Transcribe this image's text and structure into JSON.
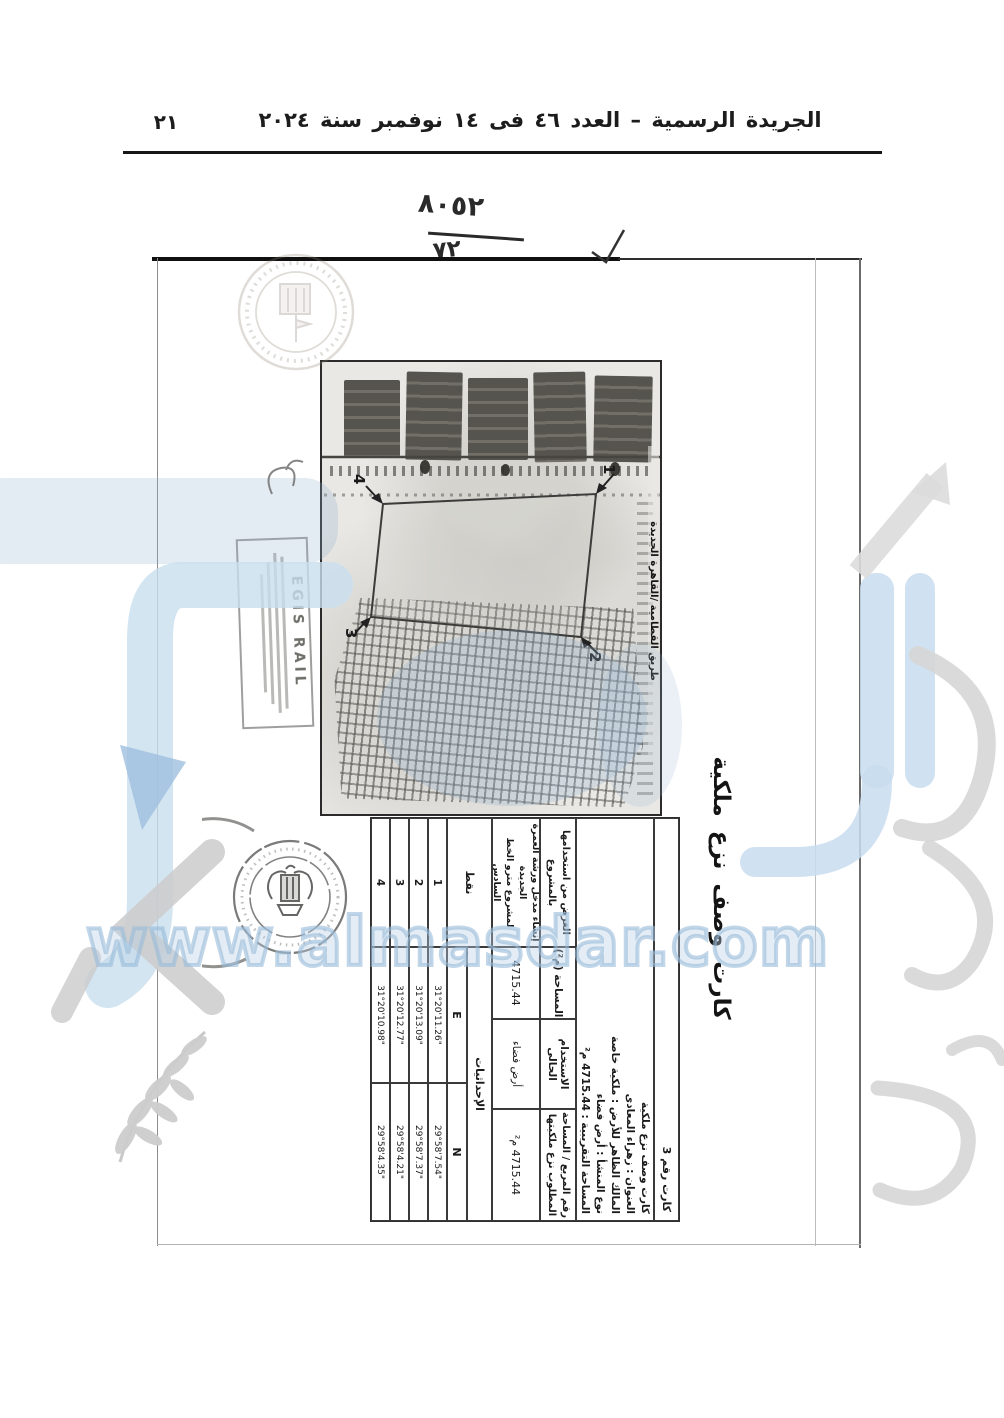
{
  "gazette": {
    "title": "الجريدة الرسمية – العدد ٤٦ فى ١٤ نوفمبر سنة ٢٠٢٤",
    "page_number": "٢١"
  },
  "annotations": {
    "fraction_top": "٨٠٥٢",
    "fraction_bottom": "٧٢"
  },
  "watermark": {
    "url": "www.almasdar.com",
    "blue": "#c8dcee",
    "tint": "#94b2d0",
    "gray": "#d6d6d6"
  },
  "card": {
    "title": "كارت وصف نزع ملكية",
    "card_no": "كارت رقم 3",
    "description": [
      "كارت وصف نزع ملكية",
      "العنوان : زهراء المعادى",
      "المالك الظاهر للأرض : ملكية خاصة",
      "نوع المنشأ : أرض فضاء",
      "المساحة التقريبية : 4715.44 م²"
    ],
    "map": {
      "road_label": "طريق القطامية /القاهرة الجديدة",
      "corners": [
        "1",
        "2",
        "3",
        "4"
      ]
    },
    "egis_stamp": "EGIS RAIL",
    "table": {
      "square_header_l1": "رقم المربع / المساحة",
      "square_header_l2": "المطلوب نزع ملكيتها",
      "square_value": "4715.44 م²",
      "use_header": "الاستخدام الحالى",
      "use_value": "أرض فضاء",
      "area_header": "المساحة (م²)",
      "area_value": "4715.44",
      "purpose_header_l1": "الغرض من استخدامها",
      "purpose_header_l2": "بالمشروع",
      "purpose_value_l1": "إنشاء مدخل ورشة العمرة",
      "purpose_value_l2": "الجديدة",
      "purpose_value_l3": "لمشروع مترو الخط السادس",
      "coords_label": "الإحداثيات",
      "points_label": "نقط",
      "n_label": "N",
      "e_label": "E",
      "rows": [
        {
          "point": "1",
          "e": "31°20'11.26\"",
          "n": "29°58'7.54\""
        },
        {
          "point": "2",
          "e": "31°20'13.09\"",
          "n": "29°58'7.37\""
        },
        {
          "point": "3",
          "e": "31°20'12.77\"",
          "n": "29°58'4.21\""
        },
        {
          "point": "4",
          "e": "31°20'10.98\"",
          "n": "29°58'4.35\""
        }
      ]
    }
  }
}
